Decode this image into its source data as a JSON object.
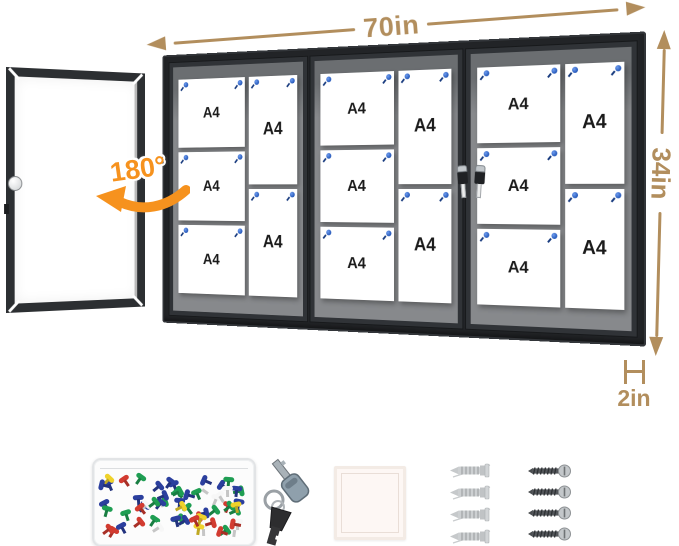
{
  "annotations": {
    "width_label": "70in",
    "height_label": "34in",
    "depth_label": "2in",
    "rotation_label": "180°",
    "arrow_color": "#b28e5d",
    "rotation_color": "#f6921e"
  },
  "board": {
    "paper_label": "A4",
    "frame_color": "#222427",
    "felt_color": "#87898c",
    "pin_color": "#2457b8",
    "sections": [
      {
        "landscape_count": 3,
        "portrait_count": 2
      },
      {
        "landscape_count": 3,
        "portrait_count": 2
      },
      {
        "landscape_count": 3,
        "portrait_count": 2
      }
    ],
    "keys_on_lock": 2
  },
  "accessories": {
    "pin_box": {
      "pin_count": 64,
      "pin_colors": [
        "#d23b30",
        "#2b3f9e",
        "#1f9e53",
        "#efd22b",
        "#f7f7f7",
        "#1f9e53",
        "#2b3f9e",
        "#d23b30"
      ]
    },
    "keys": {
      "count": 2
    },
    "anchors": {
      "count": 4
    },
    "screws": {
      "count": 4
    }
  }
}
